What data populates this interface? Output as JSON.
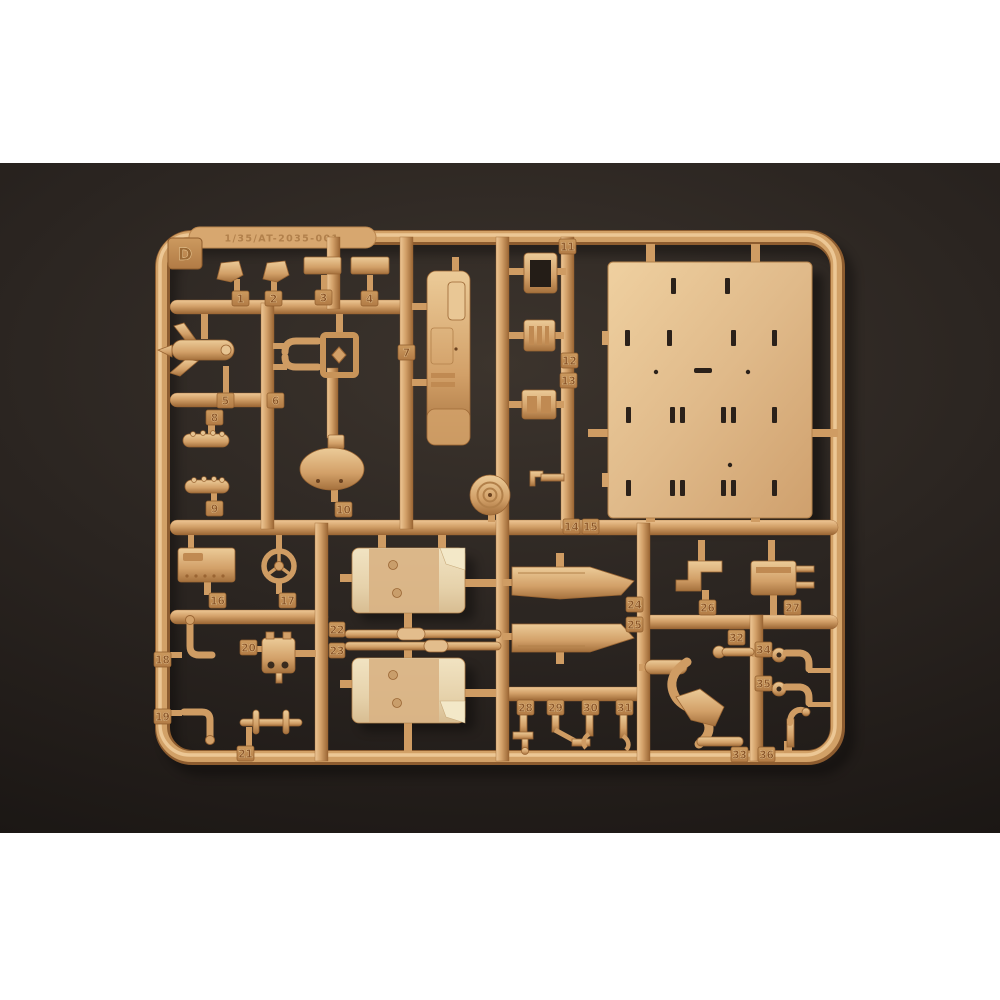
{
  "scene": {
    "type": "photograph",
    "subject": "Injection-molded plastic model kit sprue (parts runner) in tan styrene on a dark backdrop",
    "sprue_letter": "D",
    "embossed_code": "1/35/AT-2035-001",
    "visible_part_tags": 36,
    "colors": {
      "plastic": "#d2a068",
      "plastic_highlight": "#eec795",
      "plastic_shadow": "#9a6533",
      "large_panel": "#e0ba8a",
      "seat_cream": "#ecdcb8",
      "backdrop": "#2b2521",
      "page_margin": "#ffffff"
    }
  },
  "tags": [
    {
      "label": "1"
    },
    {
      "label": "2"
    },
    {
      "label": "3"
    },
    {
      "label": "4"
    },
    {
      "label": "5"
    },
    {
      "label": "6"
    },
    {
      "label": "7"
    },
    {
      "label": "8"
    },
    {
      "label": "9"
    },
    {
      "label": "10"
    },
    {
      "label": "11"
    },
    {
      "label": "12"
    },
    {
      "label": "13"
    },
    {
      "label": "14"
    },
    {
      "label": "15"
    },
    {
      "label": "16"
    },
    {
      "label": "17"
    },
    {
      "label": "18"
    },
    {
      "label": "19"
    },
    {
      "label": "20"
    },
    {
      "label": "21"
    },
    {
      "label": "22"
    },
    {
      "label": "23"
    },
    {
      "label": "24"
    },
    {
      "label": "25"
    },
    {
      "label": "26"
    },
    {
      "label": "27"
    },
    {
      "label": "28"
    },
    {
      "label": "29"
    },
    {
      "label": "30"
    },
    {
      "label": "31"
    },
    {
      "label": "32"
    },
    {
      "label": "33"
    },
    {
      "label": "34"
    },
    {
      "label": "35"
    },
    {
      "label": "36"
    }
  ]
}
